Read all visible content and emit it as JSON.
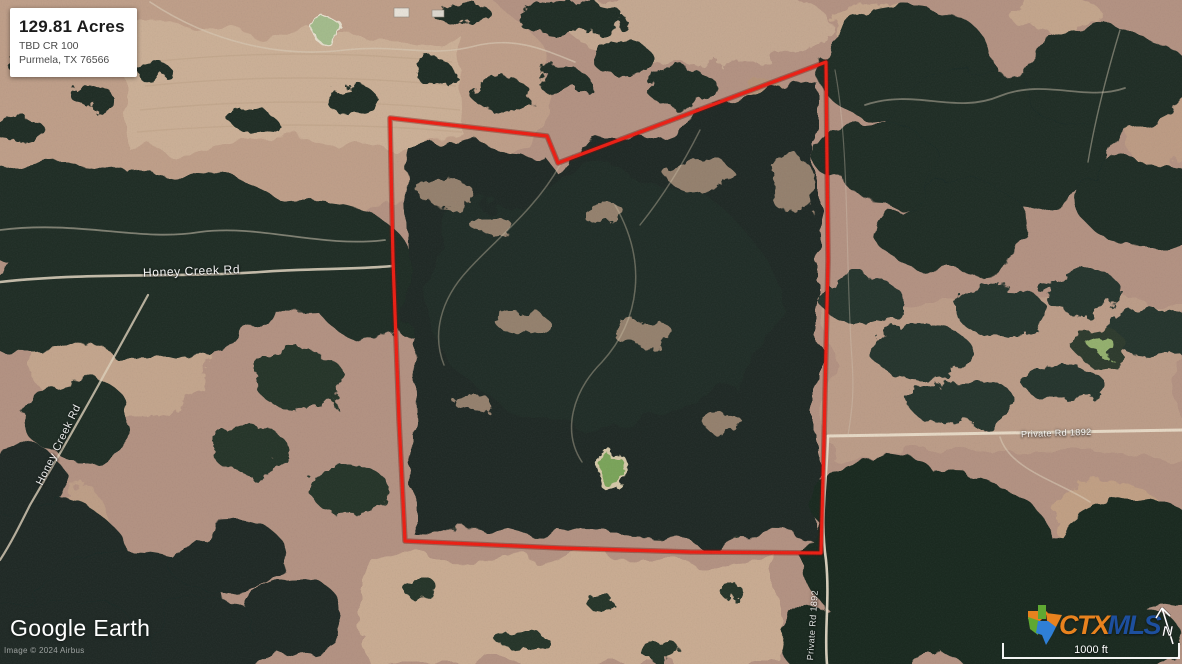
{
  "info_card": {
    "acreage": "129.81 Acres",
    "address_line1": "TBD CR 100",
    "address_line2": "Purmela, TX 76566"
  },
  "map": {
    "road_labels": {
      "honey_creek_horizontal": "Honey Creek Rd",
      "honey_creek_diagonal": "Honey Creek Rd",
      "private_rd_horizontal": "Private Rd 1892",
      "private_rd_vertical": "Private Rd 1892"
    },
    "boundary_color": "#ee1b10",
    "imagery_type": "satellite"
  },
  "attribution": {
    "logo": "Google Earth",
    "imagery_credit": "Image © 2024 Airbus"
  },
  "branding": {
    "ctx": "CTX",
    "mls": "MLS",
    "ctx_color": "#e8821e",
    "mls_color": "#1d4f9e",
    "compass_letter": "N"
  },
  "scale_bar": {
    "label": "1000 ft"
  }
}
